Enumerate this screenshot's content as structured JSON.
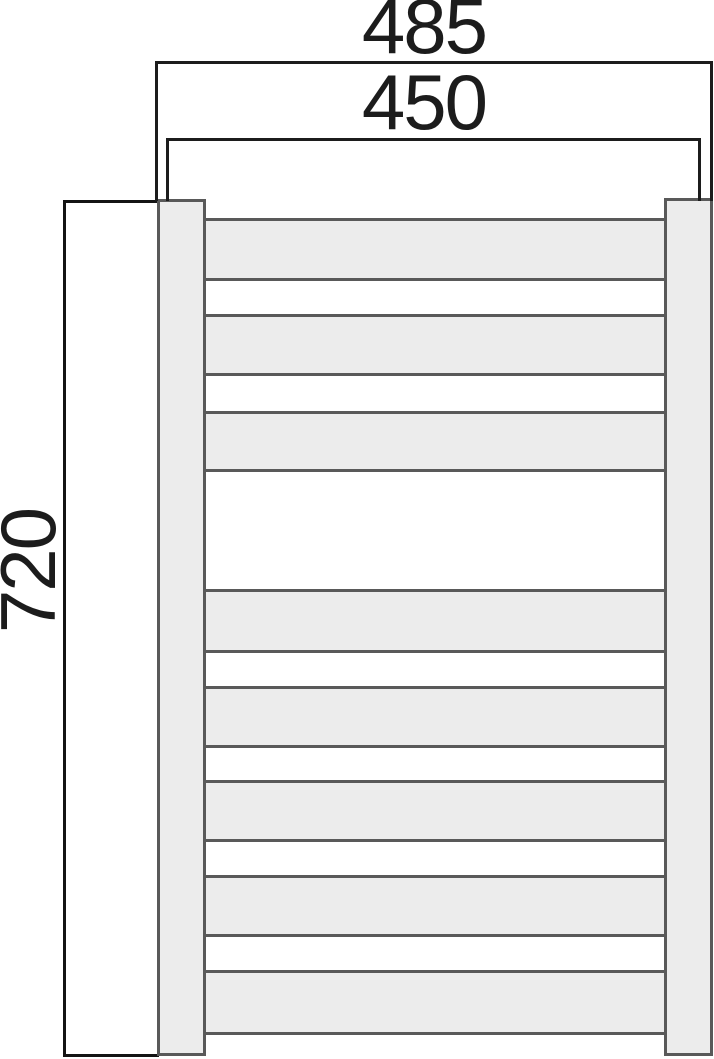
{
  "meta": {
    "title": "Towel radiator dimensioned front-view drawing"
  },
  "labels": {
    "width_overall": "485",
    "width_inner": "450",
    "height": "720"
  },
  "colors": {
    "background": "#ffffff",
    "dimension_line": "#1c1c1c",
    "text": "#1c1c1c",
    "radiator_fill": "#ececec",
    "radiator_border": "#595959",
    "height_bracket_border": "#141414"
  },
  "geometry": {
    "bracket_overall": {
      "x": 155,
      "y": 61,
      "w": 558,
      "h": 140
    },
    "bracket_inner": {
      "x": 166,
      "y": 138,
      "w": 535,
      "h": 63
    },
    "height_box": {
      "x": 63,
      "y": 200,
      "w": 96,
      "h": 857
    },
    "label_overall": {
      "x": 304,
      "y": -14,
      "w": 240,
      "h": 80
    },
    "label_inner": {
      "x": 304,
      "y": 62,
      "w": 240,
      "h": 80
    },
    "label_height": {
      "x": -72,
      "y": 531,
      "w": 200,
      "h": 80
    },
    "left_rail": {
      "x": 157,
      "y": 199,
      "w": 49,
      "h": 857
    },
    "right_rail": {
      "x": 664,
      "y": 198,
      "w": 49,
      "h": 858
    }
  },
  "radiator": {
    "rungs_x": 203,
    "rungs_w": 466,
    "rungs": [
      {
        "top": 218,
        "height": 63
      },
      {
        "top": 314,
        "height": 62
      },
      {
        "top": 411,
        "height": 61
      },
      {
        "top": 589,
        "height": 64
      },
      {
        "top": 686,
        "height": 62
      },
      {
        "top": 780,
        "height": 62
      },
      {
        "top": 875,
        "height": 62
      },
      {
        "top": 970,
        "height": 65
      }
    ]
  }
}
